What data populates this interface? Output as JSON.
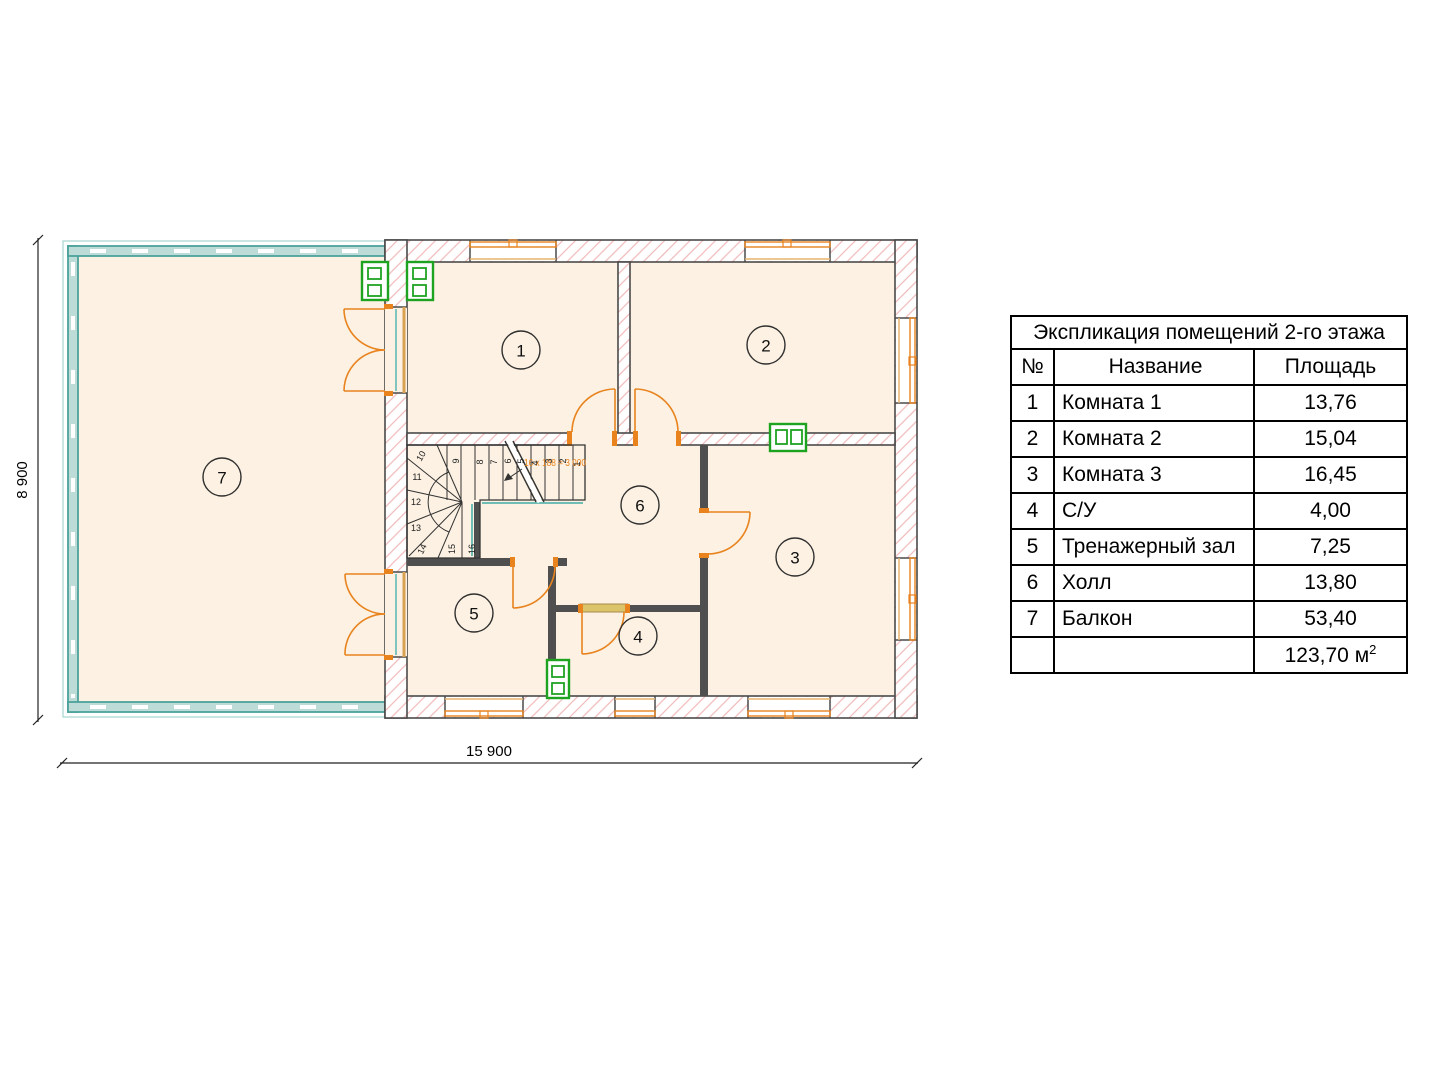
{
  "legend": {
    "title": "Экспликация помещений 2-го этажа",
    "col_num": "№",
    "col_name": "Название",
    "col_area": "Площадь",
    "rows": [
      {
        "num": "1",
        "name": "Комната 1",
        "area": "13,76"
      },
      {
        "num": "2",
        "name": "Комната 2",
        "area": "15,04"
      },
      {
        "num": "3",
        "name": "Комната 3",
        "area": "16,45"
      },
      {
        "num": "4",
        "name": "С/У",
        "area": "4,00"
      },
      {
        "num": "5",
        "name": "Тренажерный зал",
        "area": "7,25"
      },
      {
        "num": "6",
        "name": "Холл",
        "area": "13,80"
      },
      {
        "num": "7",
        "name": "Балкон",
        "area": "53,40"
      }
    ],
    "total_value": "123,70 м",
    "total_sup": "2"
  },
  "plan": {
    "dim_width": "15 900",
    "dim_height": "8 900",
    "stairs_note": "16 x 188 = 3 000",
    "steps": [
      "1",
      "2",
      "3",
      "4",
      "5",
      "6",
      "7",
      "8",
      "9",
      "10",
      "11",
      "12",
      "13",
      "14",
      "15",
      "16"
    ],
    "colors": {
      "floor": "#fcf1e2",
      "wall_hatch": "#f0b9b9",
      "accent_orange": "#e8831e",
      "balcony_teal": "#4ba29b",
      "vent_green": "#1ea321"
    }
  }
}
